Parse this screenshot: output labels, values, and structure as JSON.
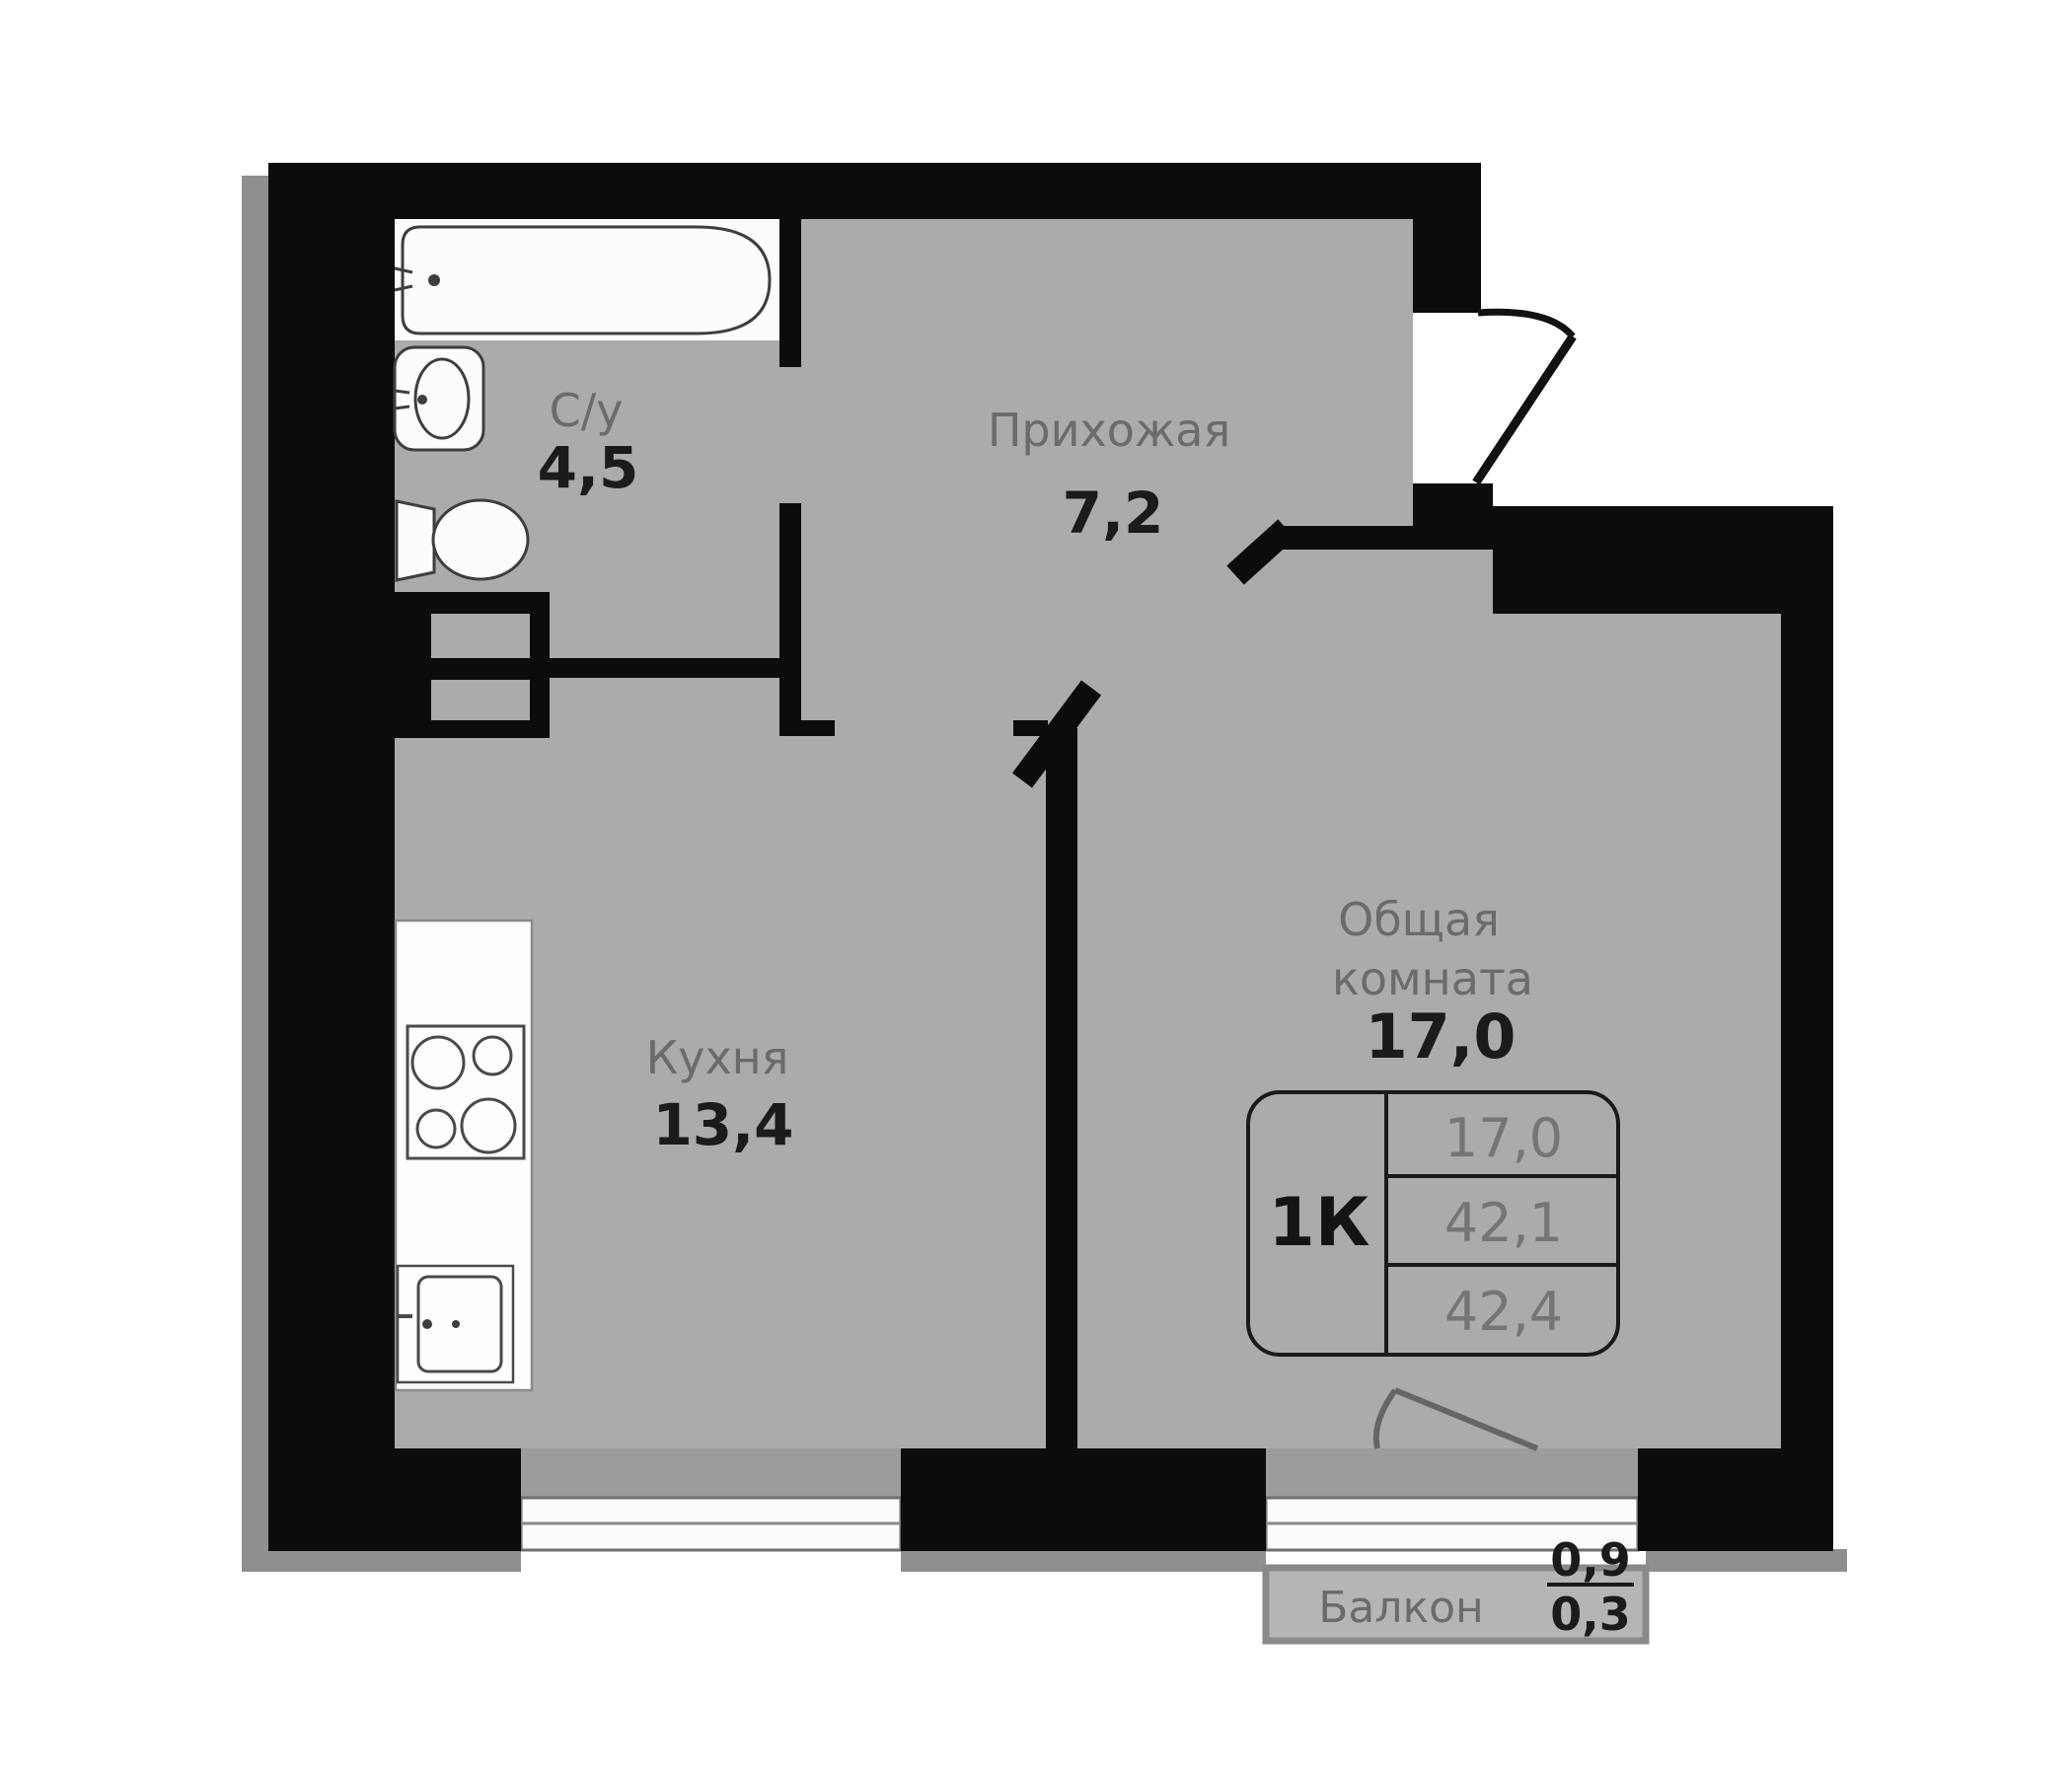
{
  "plan": {
    "title": "1K apartment floor plan",
    "rooms": {
      "bathroom": {
        "name": "С/у",
        "area": "4,5"
      },
      "hallway": {
        "name": "Прихожая",
        "area": "7,2"
      },
      "kitchen": {
        "name": "Кухня",
        "area": "13,4"
      },
      "living": {
        "name_line1": "Общая",
        "name_line2": "комната",
        "area": "17,0"
      },
      "balcony": {
        "name": "Балкон",
        "area_top": "0,9",
        "area_bottom": "0,3"
      }
    },
    "info_table": {
      "type": "1К",
      "rows": [
        "17,0",
        "42,1",
        "42,4"
      ]
    },
    "icons": [
      "bathtub-icon",
      "sink-icon",
      "toilet-icon",
      "stove-icon",
      "kitchen-sink-icon",
      "entrance-door-icon",
      "interior-door-icon",
      "balcony-door-icon",
      "window-icon",
      "vent-shaft-icon"
    ],
    "colors": {
      "wall": "#0c0c0c",
      "floor": "#ababab",
      "niche": "#9c9c9c",
      "shadow": "#8f8f8f",
      "balcony_fill": "#b5b5b5",
      "balcony_border": "#8a8a8a",
      "fixture_fill": "#fcfcfc",
      "fixture_stroke": "#3e3e3e",
      "label_gray": "#6b6b6b",
      "label_dark": "#1b1b1b"
    }
  }
}
